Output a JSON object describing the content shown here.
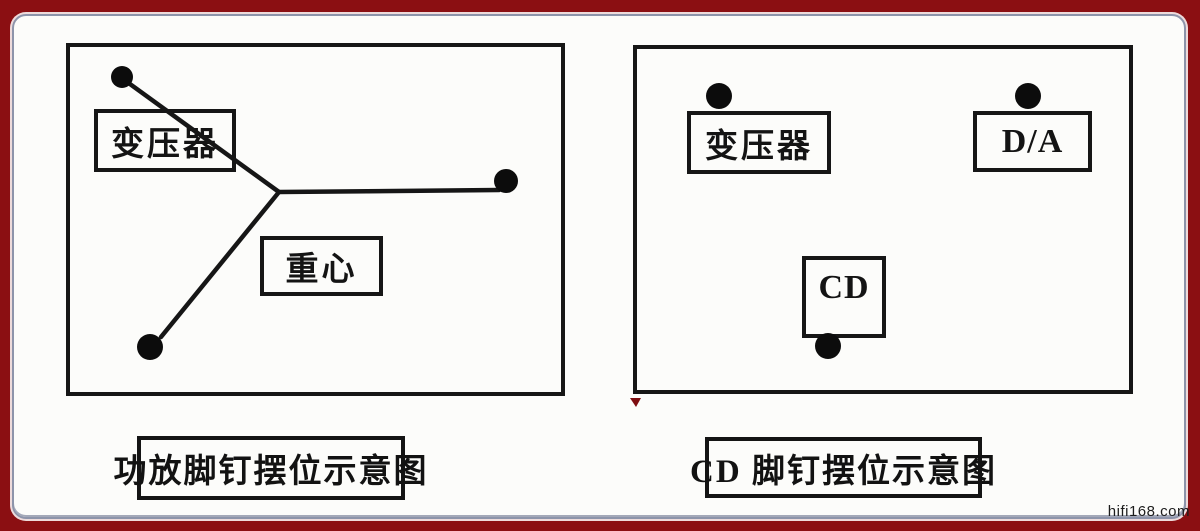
{
  "colors": {
    "frame_red": "#8B0F12",
    "page_bg": "#FCFCFA",
    "page_border": "#8D94AA",
    "ink": "#161616",
    "spike_dot": "#0C0C0C",
    "ink_mark_red": "#7E0D10"
  },
  "watermark": "hifi168.com",
  "left_diagram": {
    "caption": "功放脚钉摆位示意图",
    "transformer_label": "变压器",
    "gravity_label": "重心",
    "spike_count": 3,
    "spikes": [
      {
        "x": 56,
        "y": 34,
        "r": 11
      },
      {
        "x": 440,
        "y": 138,
        "r": 12
      },
      {
        "x": 84,
        "y": 304,
        "r": 13
      }
    ],
    "junction": {
      "x": 213,
      "y": 149
    },
    "lines": [
      [
        57,
        36,
        213,
        149
      ],
      [
        213,
        149,
        433,
        147
      ],
      [
        213,
        149,
        95,
        294
      ]
    ]
  },
  "right_diagram": {
    "caption": "CD 脚钉摆位示意图",
    "transformer_label": "变压器",
    "da_label": "D/A",
    "cd_label": "CD",
    "spike_count": 3,
    "spikes": [
      {
        "x": 86,
        "y": 51,
        "r": 13
      },
      {
        "x": 395,
        "y": 51,
        "r": 13
      },
      {
        "x": 195,
        "y": 301,
        "r": 13
      }
    ],
    "lines": []
  }
}
